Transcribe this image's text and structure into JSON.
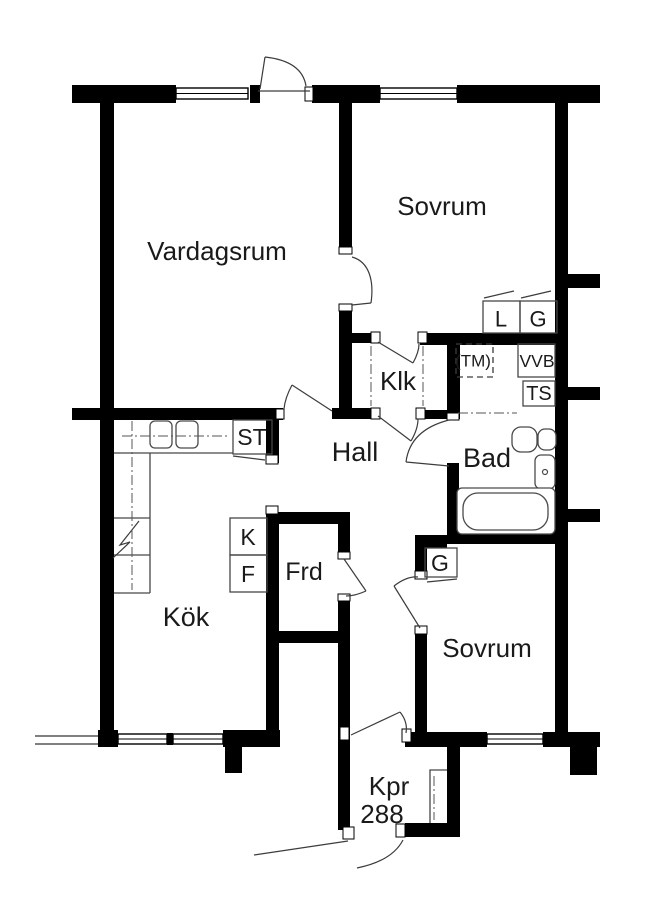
{
  "floorplan": {
    "title": "Apartment floor plan",
    "apartment_number": "288",
    "rooms": [
      {
        "id": "vardagsrum",
        "label": "Vardagsrum"
      },
      {
        "id": "sovrum-1",
        "label": "Sovrum"
      },
      {
        "id": "klk",
        "label": "Klk"
      },
      {
        "id": "hall",
        "label": "Hall"
      },
      {
        "id": "bad",
        "label": "Bad"
      },
      {
        "id": "kok",
        "label": "Kök"
      },
      {
        "id": "frd",
        "label": "Frd"
      },
      {
        "id": "sovrum-2",
        "label": "Sovrum"
      },
      {
        "id": "kpr",
        "label": "Kpr"
      }
    ],
    "small_labels": [
      {
        "id": "closet-l",
        "label": "L"
      },
      {
        "id": "closet-g-top",
        "label": "G"
      },
      {
        "id": "vvb",
        "label": "VVB"
      },
      {
        "id": "ts",
        "label": "TS"
      },
      {
        "id": "tm",
        "label": "(TM)"
      },
      {
        "id": "st",
        "label": "ST"
      },
      {
        "id": "kyl",
        "label": "K"
      },
      {
        "id": "frys",
        "label": "F"
      },
      {
        "id": "closet-g-bottom",
        "label": "G"
      }
    ],
    "colors": {
      "wall": "#000000",
      "background": "#ffffff",
      "thin_line": "#474747"
    }
  }
}
